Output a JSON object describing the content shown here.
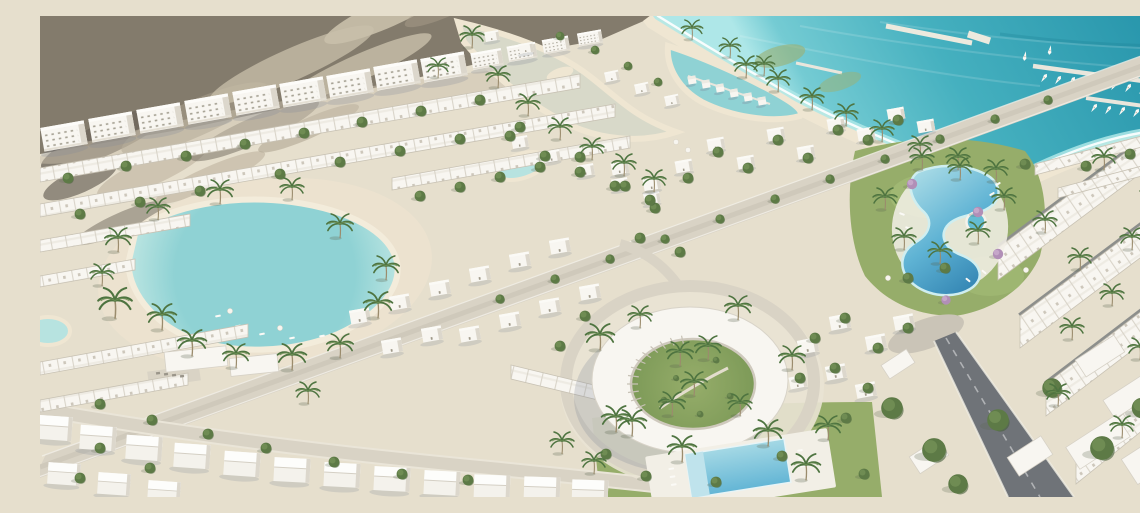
{
  "scene": {
    "title": "Aerial rendering of a coastal resort master plan with white villas, lagoon, marina and circular clubhouse",
    "caption": "Bird's-eye architectural visualization: desert dunes, rows of white apartments and townhouses, a swimmable turquoise lagoon with sandy beach, canals with overwater bungalows, a sea marina with piers and boats, a ring-shaped clubhouse, resort pools and palm-lined boulevard.",
    "features": [
      "desert-dunes",
      "sea",
      "beach-coastline",
      "marina-piers",
      "boats",
      "canals",
      "water-bungalows",
      "swimmable-lagoon",
      "apartment-row",
      "townhouse-rows",
      "detached-villas",
      "circular-clubhouse",
      "resort-pool",
      "spa-pool",
      "residential-pool",
      "main-boulevard",
      "asphalt-road",
      "palm-trees",
      "lawns"
    ],
    "counts": {
      "water_bungalows": 6,
      "marina_boats": 19,
      "pools": 3,
      "piers": 3
    }
  },
  "palette": {
    "ground": "#e6dfcd",
    "desert": "#837b6c",
    "desert_dark": "#6e675c",
    "desert_light": "#c9c0ab",
    "desert_mid": "#a59b88",
    "sea_deep": "#2795ab",
    "sea": "#45b0bf",
    "sea_light": "#74cbd3",
    "shallow": "#aee7e8",
    "beach": "#efe6d2",
    "lagoon": "#8fd2d4",
    "lagoon_edge": "#b7e3e0",
    "pool_deep": "#2f81b0",
    "pool": "#5fb3d4",
    "pool_light": "#a9dbe6",
    "lawn": "#96ad6a",
    "lawn_dark": "#7d9a58",
    "tree": "#5d7a46",
    "tree_dark": "#48603a",
    "tree_light": "#79965a",
    "palm": "#4e7440",
    "purple_tree": "#b18fb7",
    "building": "#f8f6f1",
    "building_shade": "#dcd7cc",
    "window": "#8d8878",
    "road": "#d9d3c5",
    "asphalt": "#6f7378",
    "walk_dark": "#8d8f8c",
    "shadow": "#7e8798"
  }
}
